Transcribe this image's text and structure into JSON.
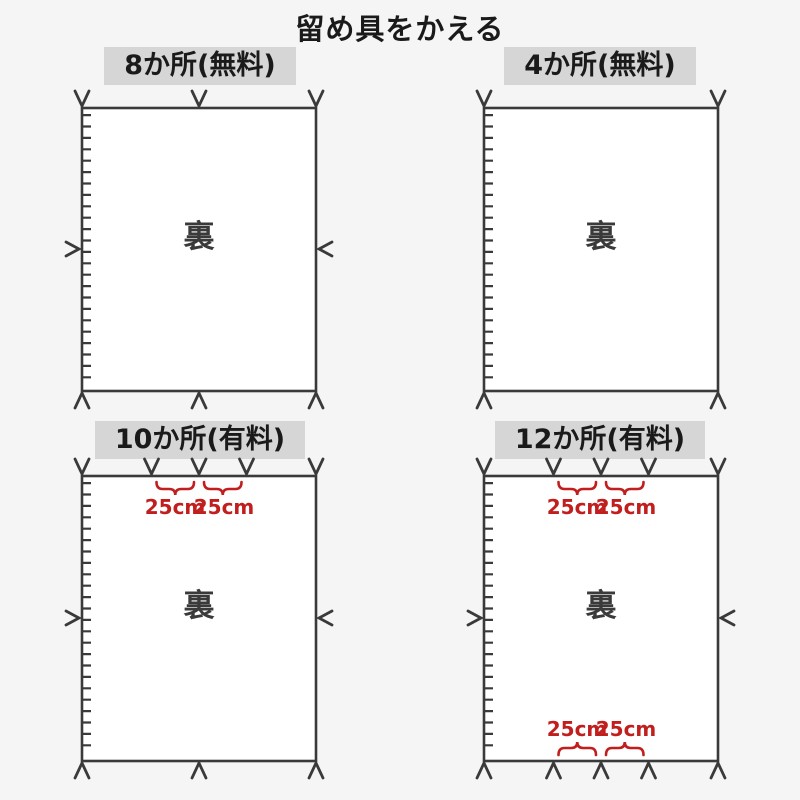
{
  "page": {
    "title": "留め具をかえる",
    "background": "#f5f5f5"
  },
  "colors": {
    "line": "#3a3a3a",
    "accent_red": "#c11e1e",
    "header_bg": "#d6d6d6",
    "cover_fill": "#ffffff"
  },
  "panels": [
    {
      "label": "8か所(無料)",
      "back_label": "裏"
    },
    {
      "label": "4か所(無料)",
      "back_label": "裏"
    },
    {
      "label": "10か所(有料)",
      "back_label": "裏",
      "top_measures": [
        "25cm",
        "25cm"
      ]
    },
    {
      "label": "12か所(有料)",
      "back_label": "裏",
      "top_measures": [
        "25cm",
        "25cm"
      ],
      "bottom_measures": [
        "25cm",
        "25cm"
      ]
    }
  ]
}
